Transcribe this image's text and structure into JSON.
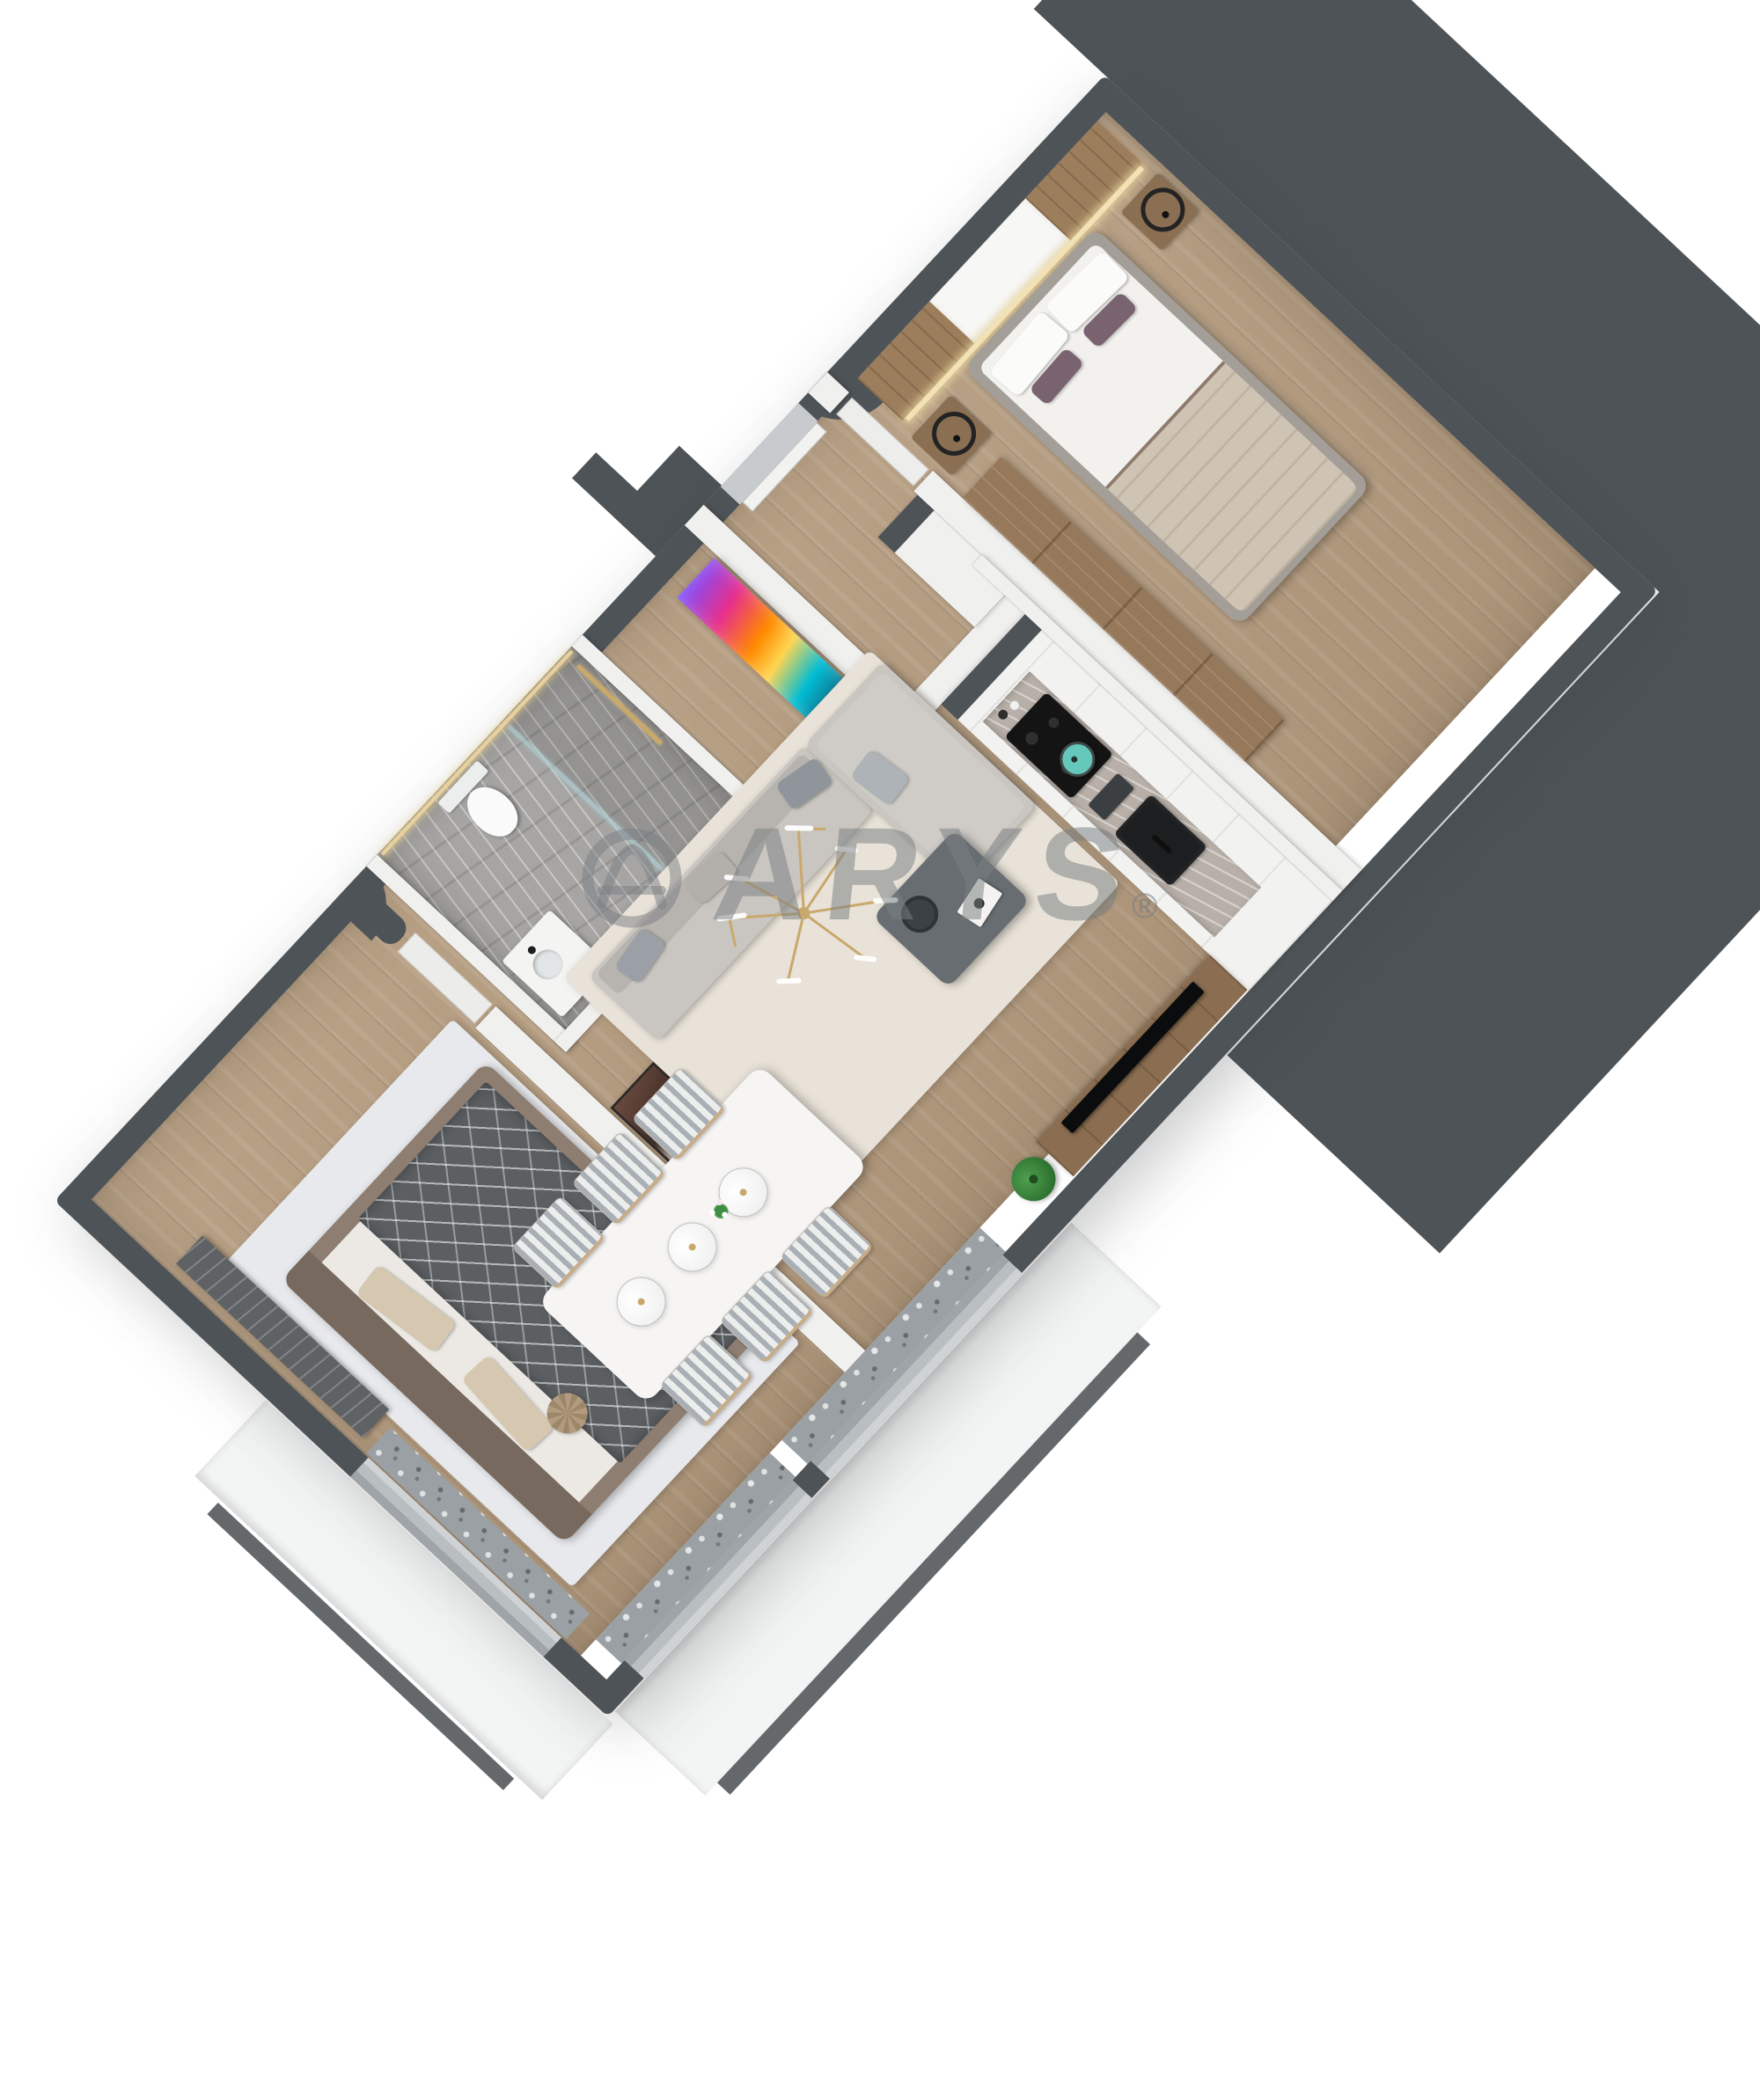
{
  "watermark": {
    "logo_icon": "arys-circle-a-logo-icon",
    "brand_text": "ARYS",
    "registered_mark": "®",
    "color": "#7b8083"
  },
  "scene": {
    "type": "isometric-3d-floor-plan",
    "subject": "one-bedroom-plus-living apartment rendered top-down",
    "rotation_deg": -47,
    "background": "#ffffff",
    "structure": {
      "outer_walls": "dark-charcoal",
      "inner_walls": "white",
      "adjacent_building_mass": "solid-dark-gray",
      "balconies": "light-stone terraces with sheer curtains at windows"
    },
    "rooms": [
      {
        "name": "living-room",
        "floor": "wood",
        "furniture": [
          "l-shaped-gray-sofa",
          "gray-coffee-table-with-tray-and-book",
          "cream-area-rug",
          "gold-branch-chandelier",
          "wood-tv-console",
          "flat-tv",
          "potted-plant",
          "portrait-artwork"
        ]
      },
      {
        "name": "dining-area",
        "floor": "wood",
        "furniture": [
          "white-dining-table",
          "six-striped-chairs",
          "three-glass-globe-pendants",
          "flower-centerpiece"
        ]
      },
      {
        "name": "kitchen",
        "floor": "wood",
        "furniture": [
          "white-cabinet-run",
          "marble-counter-niche",
          "black-induction-cooktop",
          "teal-pot",
          "black-sink",
          "tall-cabinet-column",
          "bottles"
        ]
      },
      {
        "name": "master-bedroom",
        "floor": "wood",
        "furniture": [
          "double-bed-white-duvet",
          "beige-blanket",
          "mauve-accent-pillows",
          "wood-headboard-panels",
          "led-strip-light",
          "two-nightstands",
          "two-black-ring-lamps",
          "wood-wardrobe"
        ]
      },
      {
        "name": "second-bedroom",
        "floor": "wood",
        "furniture": [
          "double-bed-dark-patterned-throw",
          "beige-pillows",
          "round-cushion",
          "blue-marbled-rug",
          "dark-wall-tv-panel",
          "window-curtains"
        ]
      },
      {
        "name": "bathroom",
        "floor": "gray-marble",
        "furniture": [
          "walk-in-shower",
          "glass-partition",
          "gold-trim-light",
          "wall-hung-toilet",
          "white-washbasin-vanity"
        ]
      },
      {
        "name": "entry-hall",
        "floor": "wood",
        "furniture": [
          "colorful-abstract-artwork",
          "entrance-door",
          "white-hall-cabinet"
        ]
      }
    ]
  },
  "palette": {
    "wall_dark": "#4e5357",
    "wall_white": "#f0f0ef",
    "wood": "#b49b7e",
    "wood_dark": "#9c7e5c",
    "wood_console": "#8b6e51",
    "marble": "#a6a5a3",
    "counter": "#b8b0a8",
    "rug_living": "#e8e2d8",
    "rug_blue": "#e7e9ec",
    "sofa": "#c9c5c0",
    "sofa_dark": "#b7b3ae",
    "table_dark": "#676d71",
    "white_furniture": "#f6f5f3",
    "stripe": "#a9b0b5",
    "curtain": "#9aa0a3",
    "duvet_dark": "#5c5f62",
    "frame_taupe": "#8e7e72",
    "pillow_beige": "#d6c8b0",
    "blanket": "#cfc4b3",
    "mauve": "#7a6370",
    "gold": "#c9a86b",
    "teal": "#66c7bb",
    "green": "#3f8f43",
    "black": "#141414",
    "glass": "#bfd3d6",
    "terrace": "#f3f4f4",
    "portrait_dark": "#4a372f",
    "art_pink": "#e7308c",
    "art_orange": "#ff8a00",
    "art_teal": "#00bcd4",
    "art_purple": "#7c4dff",
    "watermark": "#7b8083"
  }
}
